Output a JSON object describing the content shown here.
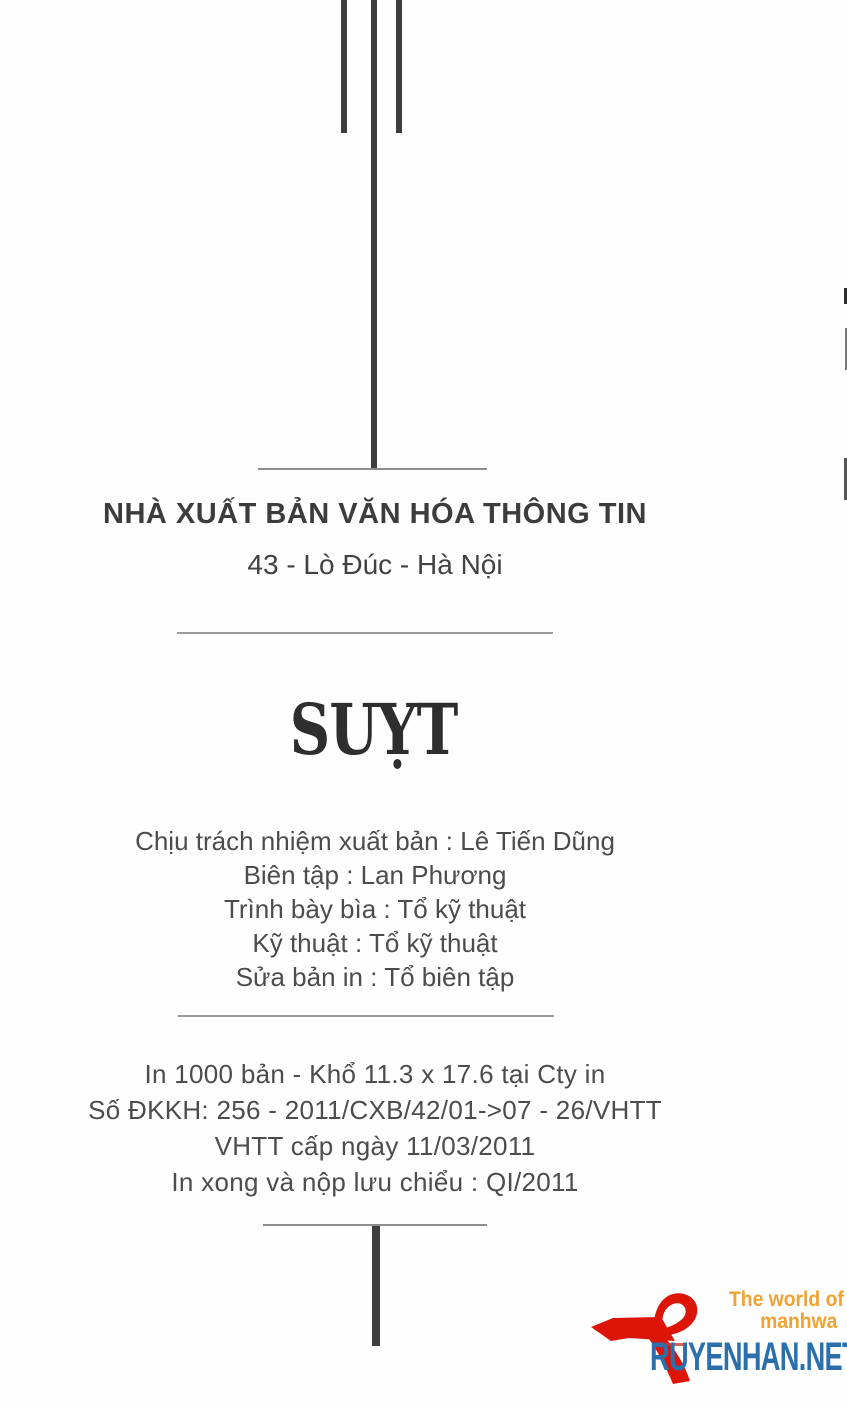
{
  "page": {
    "publisher": "NHÀ XUẤT BẢN VĂN HÓA THÔNG TIN",
    "address": "43 - Lò Đúc - Hà Nội",
    "title": "SUỴT",
    "credits": [
      "Chịu trách nhiệm xuất bản : Lê Tiến Dũng",
      "Biên tập : Lan Phương",
      "Trình bày bìa : Tổ kỹ thuật",
      "Kỹ thuật : Tổ kỹ thuật",
      "Sửa bản in : Tổ biên tập"
    ],
    "printing": [
      "In 1000 bản - Khổ 11.3 x 17.6 tại Cty in",
      "Số ĐKKH: 256 - 2011/CXB/42/01->07 - 26/VHTT",
      "VHTT cấp ngày 11/03/2011",
      "In xong và nộp lưu chiểu : QI/2011"
    ]
  },
  "watermark": {
    "tagline_line1": "The world of",
    "tagline_line2": "manhwa",
    "site": "RUYENHAN.NET",
    "icon": "ribbon-logo-icon",
    "colors": {
      "tagline": "#f0a233",
      "site": "#2b70ad",
      "ribbon": "#dd1507"
    }
  }
}
